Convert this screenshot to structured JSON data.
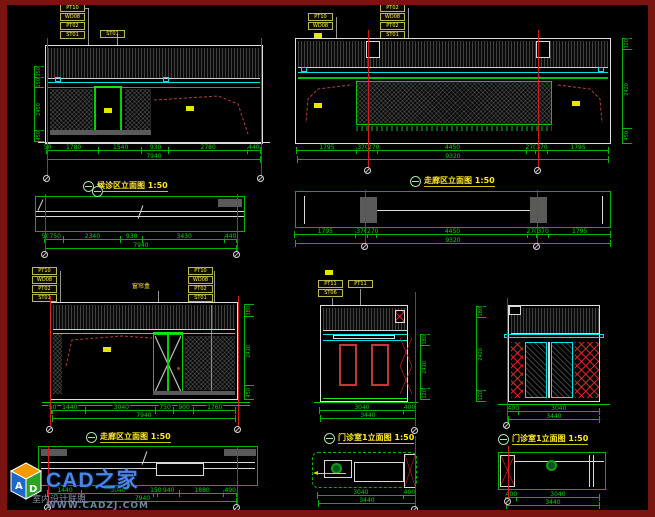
{
  "palette": {
    "green": "#00c800",
    "cyan": "#00e6e6",
    "grid_red": "#df1a1a",
    "dashed_red": "#b04040",
    "yellow": "#ffe928",
    "white_line": "#dedede",
    "gray_fill": "#5a5a5a",
    "border_maroon": "#7a1410"
  },
  "views": {
    "tl": {
      "title": "候诊区立面图",
      "scale": "1:50",
      "tags": [
        "PT10",
        "WD08",
        "PT02",
        "ST01"
      ],
      "tag_single": "ST01",
      "dims": [
        "50",
        "1780",
        "1540",
        "930",
        "2780",
        "440"
      ],
      "total": "7940",
      "vdims": [
        "350",
        "150",
        "2450",
        "450"
      ]
    },
    "tr": {
      "title": "走廊区立面图",
      "scale": "1:50",
      "tags_a": [
        "PT10",
        "WD08"
      ],
      "tags_b": [
        "PT02",
        "WD08",
        "PT02",
        "ST01"
      ],
      "dims": [
        "1795",
        "370",
        "270",
        "4450",
        "270",
        "370",
        "1795"
      ],
      "total": "9320",
      "vdims": [
        "320",
        "2420",
        "450"
      ]
    },
    "ml": {
      "dims": [
        "50",
        "750",
        "2340",
        "930",
        "3430",
        "440"
      ],
      "total": "7940"
    },
    "mr": {
      "dims": [
        "1795",
        "370",
        "270",
        "4450",
        "270",
        "370",
        "1795"
      ],
      "total": "9320"
    },
    "bl": {
      "title": "走廊区立面图",
      "scale": "1:50",
      "tags": [
        "PT10",
        "WD08",
        "PT02",
        "ST01"
      ],
      "tags_b": [
        "PT10",
        "WD08",
        "PT02",
        "ST01"
      ],
      "curtain_label": "窗帘盒",
      "dims": [
        "50",
        "1440",
        "3040",
        "750",
        "900",
        "1760"
      ],
      "total": "7940",
      "vdims": [
        "380",
        "2420",
        "450"
      ]
    },
    "bm": {
      "title": "门诊室1立面图",
      "scale": "1:50",
      "tags": [
        "PT11",
        "ST06"
      ],
      "tag_single": "PT11",
      "dims": [
        "3040",
        "400"
      ],
      "total": "3440",
      "vdims": [
        "180",
        "2420",
        "120"
      ]
    },
    "br": {
      "title": "门诊室1立面图",
      "scale": "1:50",
      "dims": [
        "400",
        "3040"
      ],
      "total": "3440",
      "vdims": [
        "180",
        "2420",
        "120"
      ]
    },
    "bls": {
      "dims": [
        "1440",
        "3040",
        "150",
        "940",
        "1880",
        "490"
      ],
      "total": "7940"
    },
    "bms": {
      "dims": [
        "3040",
        "400"
      ],
      "total": "3440"
    },
    "brs": {
      "dims": [
        "400",
        "3040"
      ],
      "total": "3440"
    }
  },
  "watermark": {
    "brand": "CAD之家",
    "community": "室内设计联盟",
    "url": "WWW.CADZJ.COM",
    "cube": {
      "left": "A",
      "right": "D"
    }
  }
}
